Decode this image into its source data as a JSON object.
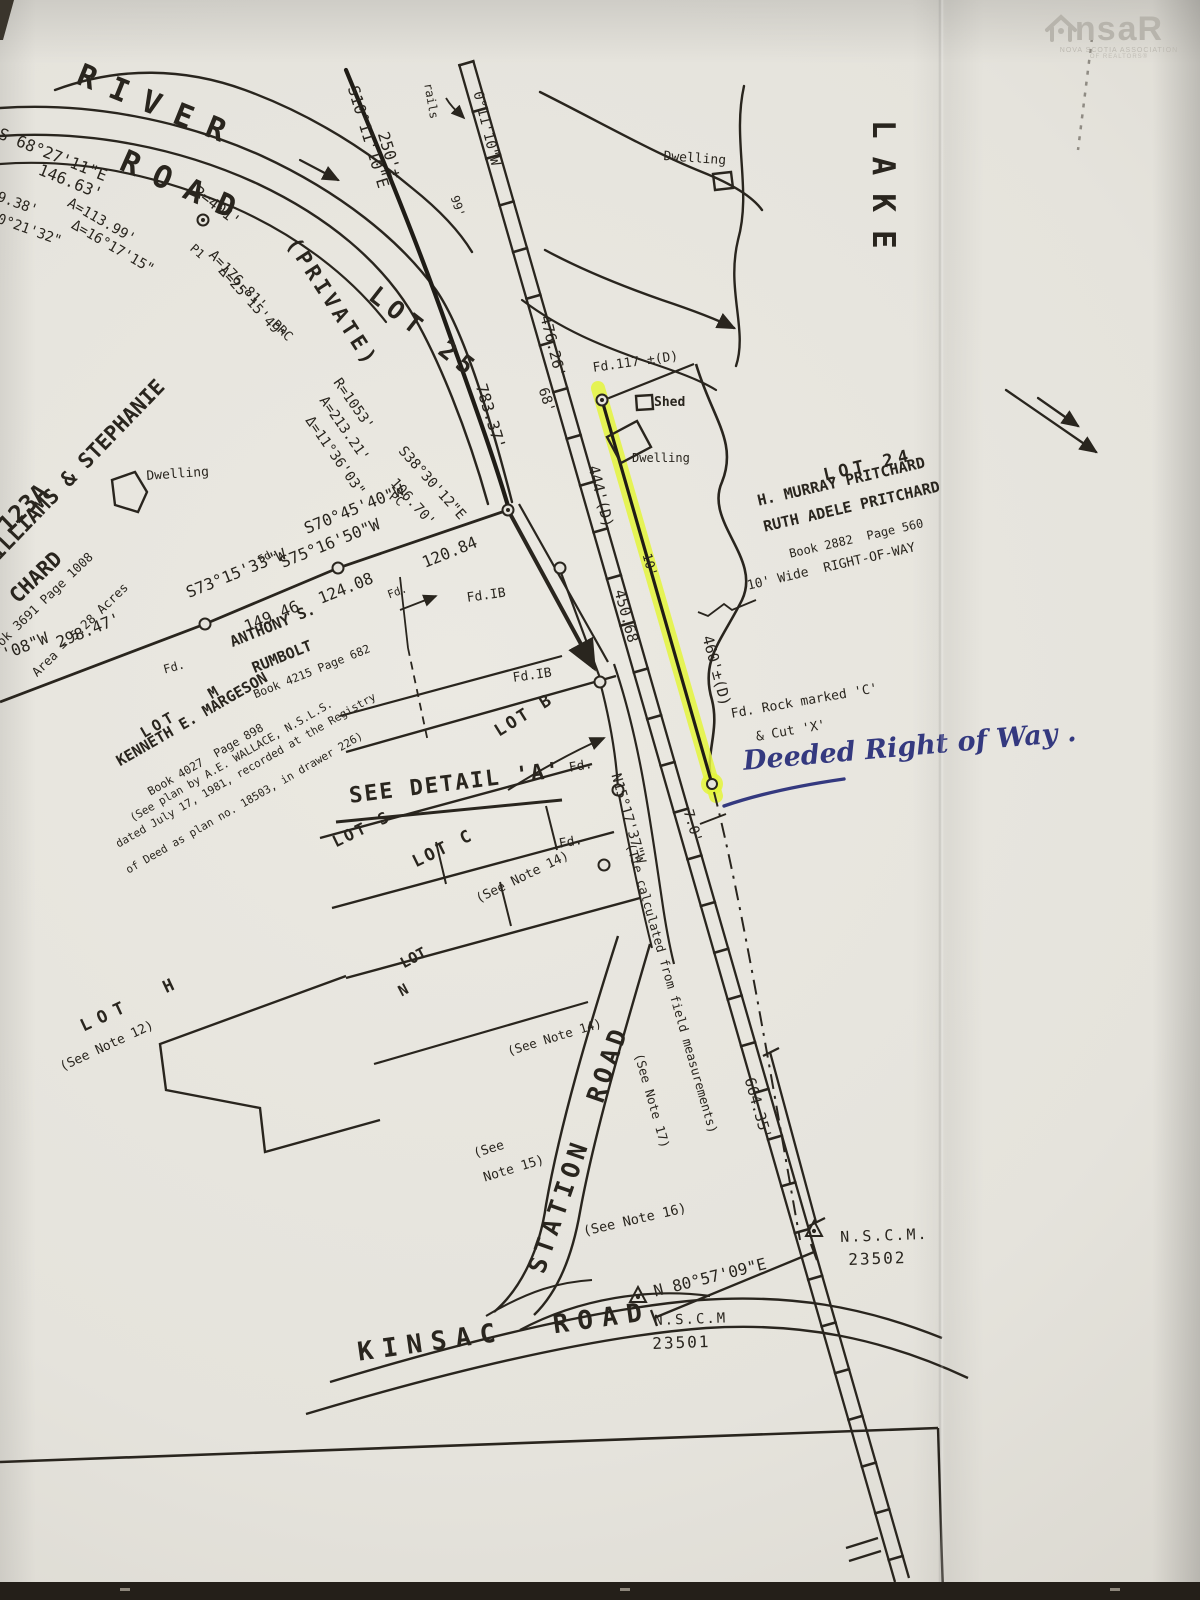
{
  "document": {
    "type_hint": "scanned property survey plan, photographed page",
    "ink_color": "#29251e",
    "highlight_color": "#e4f53c",
    "handwriting_color": "#34397f",
    "paper_color": "#e5e3dc"
  },
  "logo": {
    "ns": "ns",
    "ar": "aR",
    "line1": "NOVA SCOTIA ASSOCIATION",
    "line2": "OF REALTORS®",
    "house_icon": "house-icon"
  },
  "labels": [
    {
      "id": "river",
      "t": "RIVER",
      "x": 84,
      "y": 60,
      "r": 22,
      "s": 31,
      "ls": 16,
      "b": 1
    },
    {
      "id": "road-river",
      "t": "ROAD",
      "x": 128,
      "y": 146,
      "r": 24,
      "s": 31,
      "ls": 16,
      "b": 1
    },
    {
      "id": "brg-s68",
      "t": "S 68°27'11\"E",
      "x": 2,
      "y": 126,
      "r": 22,
      "s": 16
    },
    {
      "id": "dist-14663",
      "t": "146.63'",
      "x": 42,
      "y": 162,
      "r": 22,
      "s": 16
    },
    {
      "id": "dist-938",
      "t": "9.38'",
      "x": 0,
      "y": 190,
      "r": 20,
      "s": 14
    },
    {
      "id": "brg-02132",
      "t": "0°21'32\"",
      "x": 0,
      "y": 212,
      "r": 20,
      "s": 14
    },
    {
      "id": "arc-11399",
      "t": "A=113.99'",
      "x": 72,
      "y": 196,
      "r": 30,
      "s": 14
    },
    {
      "id": "delta-161715",
      "t": "Δ=16°17'15\"",
      "x": 76,
      "y": 218,
      "r": 30,
      "s": 14
    },
    {
      "id": "rad-401",
      "t": "R=401'",
      "x": 200,
      "y": 184,
      "r": 38,
      "s": 15
    },
    {
      "id": "pt-p1-a",
      "t": "P1",
      "x": 196,
      "y": 242,
      "r": 42,
      "s": 12
    },
    {
      "id": "arc-17681",
      "t": "A=176.81'",
      "x": 216,
      "y": 248,
      "r": 46,
      "s": 14
    },
    {
      "id": "delta-251549",
      "t": "Δ=25°15'49\"",
      "x": 226,
      "y": 264,
      "r": 48,
      "s": 14
    },
    {
      "id": "pt-prc",
      "t": "PRC",
      "x": 278,
      "y": 318,
      "r": 45,
      "s": 13
    },
    {
      "id": "private",
      "t": "(PRIVATE)",
      "x": 300,
      "y": 234,
      "r": 57,
      "s": 21,
      "ls": 4,
      "b": 1
    },
    {
      "id": "lot-25",
      "t": "LOT 25",
      "x": 380,
      "y": 282,
      "r": 38,
      "s": 25,
      "ls": 7,
      "b": 1
    },
    {
      "id": "rad-1053",
      "t": "R=1053'",
      "x": 342,
      "y": 376,
      "r": 55,
      "s": 14
    },
    {
      "id": "arc-21321",
      "t": "A=213.21'",
      "x": 328,
      "y": 394,
      "r": 55,
      "s": 14
    },
    {
      "id": "delta-113603",
      "t": "Δ=11°36'03\"",
      "x": 314,
      "y": 414,
      "r": 55,
      "s": 14
    },
    {
      "id": "brg-s38",
      "t": "S38°30'12\"E",
      "x": 406,
      "y": 444,
      "r": 48,
      "s": 14
    },
    {
      "id": "dist-10670",
      "t": "106.70'",
      "x": 398,
      "y": 476,
      "r": 48,
      "s": 14
    },
    {
      "id": "pt-pc",
      "t": "PC",
      "x": 394,
      "y": 490,
      "r": 35,
      "s": 12
    },
    {
      "id": "dist-78337",
      "t": "783.37'",
      "x": 488,
      "y": 382,
      "r": 73,
      "s": 16
    },
    {
      "id": "brg-s10",
      "t": "S10°11'10\"E",
      "x": 360,
      "y": 84,
      "r": 73,
      "s": 16
    },
    {
      "id": "dist-250",
      "t": "250'±",
      "x": 390,
      "y": 130,
      "r": 73,
      "s": 16
    },
    {
      "id": "rails",
      "t": "rails",
      "x": 434,
      "y": 82,
      "r": 80,
      "s": 12
    },
    {
      "id": "brg-s0",
      "t": "0°11'10\"W",
      "x": 484,
      "y": 90,
      "r": 76,
      "s": 14
    },
    {
      "id": "dist-99",
      "t": "99'",
      "x": 460,
      "y": 194,
      "r": 72,
      "s": 12
    },
    {
      "id": "dwelling-1",
      "t": "Dwelling",
      "x": 664,
      "y": 150,
      "r": 4,
      "s": 13
    },
    {
      "id": "lake",
      "t": "LAKE",
      "x": 898,
      "y": 120,
      "r": 90,
      "s": 31,
      "ls": 18,
      "b": 1
    },
    {
      "id": "dist-47626",
      "t": "476.26'",
      "x": 552,
      "y": 314,
      "r": 76,
      "s": 15
    },
    {
      "id": "dist-68",
      "t": "68'",
      "x": 549,
      "y": 386,
      "r": 72,
      "s": 14
    },
    {
      "id": "fd-117",
      "t": "Fd.117 ±(D)",
      "x": 592,
      "y": 362,
      "r": -8,
      "s": 13
    },
    {
      "id": "shed",
      "t": "Shed",
      "x": 654,
      "y": 396,
      "r": 0,
      "s": 13,
      "b": 1
    },
    {
      "id": "dwelling-2",
      "t": "Dwelling",
      "x": 632,
      "y": 452,
      "r": 0,
      "s": 12
    },
    {
      "id": "dist-444",
      "t": "444'(D)",
      "x": 600,
      "y": 464,
      "r": 76,
      "s": 15
    },
    {
      "id": "lot-24",
      "t": "LOT 24",
      "x": 822,
      "y": 468,
      "r": -13,
      "s": 17,
      "ls": 5,
      "b": 1
    },
    {
      "id": "owner-murray",
      "t": "H. MURRAY PRITCHARD",
      "x": 756,
      "y": 494,
      "r": -13,
      "s": 15,
      "b": 1
    },
    {
      "id": "owner-ruth",
      "t": "RUTH ADELE PRITCHARD",
      "x": 762,
      "y": 520,
      "r": -13,
      "s": 15,
      "b": 1
    },
    {
      "id": "book-2882",
      "t": "Book 2882  Page 560",
      "x": 788,
      "y": 548,
      "r": -13,
      "s": 12
    },
    {
      "id": "row-10wide",
      "t": "10' Wide  RIGHT-OF-WAY",
      "x": 746,
      "y": 580,
      "r": -13,
      "s": 13
    },
    {
      "id": "dist-10",
      "t": "10'",
      "x": 652,
      "y": 552,
      "r": 74,
      "s": 13
    },
    {
      "id": "dist-45068",
      "t": "450.68",
      "x": 626,
      "y": 588,
      "r": 75,
      "s": 15
    },
    {
      "id": "dist-460",
      "t": "460'±(D)",
      "x": 714,
      "y": 634,
      "r": 75,
      "s": 15
    },
    {
      "id": "fd-rock-1",
      "t": "Fd. Rock marked 'C'",
      "x": 730,
      "y": 708,
      "r": -10,
      "s": 13
    },
    {
      "id": "fd-rock-2",
      "t": "& Cut 'X'",
      "x": 755,
      "y": 731,
      "r": -10,
      "s": 13
    },
    {
      "id": "handwriting",
      "t": "Deeded Right of Way .",
      "x": 742,
      "y": 748,
      "r": -5,
      "s": 27,
      "hw": 1
    },
    {
      "id": "dist-70",
      "t": "7.0'",
      "x": 694,
      "y": 808,
      "r": 73,
      "s": 14
    },
    {
      "id": "brg-n15",
      "t": "N15°17'37\"W",
      "x": 622,
      "y": 772,
      "r": 74,
      "s": 14
    },
    {
      "id": "tie-note",
      "t": "(Tie calculated from field measurements)",
      "x": 636,
      "y": 842,
      "r": 74,
      "s": 12.5
    },
    {
      "id": "see-note-17",
      "t": "(See Note 17)",
      "x": 644,
      "y": 1052,
      "r": 74,
      "s": 12.5
    },
    {
      "id": "dist-66435",
      "t": "664.35'",
      "x": 756,
      "y": 1076,
      "r": 74,
      "s": 15
    },
    {
      "id": "brg-s70",
      "t": "S70°45'40\"W",
      "x": 302,
      "y": 522,
      "r": -22,
      "s": 16
    },
    {
      "id": "dist-12084",
      "t": "120.84",
      "x": 420,
      "y": 556,
      "r": -22,
      "s": 16
    },
    {
      "id": "brg-s75",
      "t": "S75°16'50\"W",
      "x": 278,
      "y": 556,
      "r": -22,
      "s": 16
    },
    {
      "id": "dist-12408",
      "t": "124.08",
      "x": 316,
      "y": 592,
      "r": -22,
      "s": 16
    },
    {
      "id": "brg-s73",
      "t": "S73°15'33\"W",
      "x": 184,
      "y": 586,
      "r": -22,
      "s": 16
    },
    {
      "id": "dist-14946",
      "t": "149.46",
      "x": 242,
      "y": 620,
      "r": -22,
      "s": 16
    },
    {
      "id": "brg-08w",
      "t": "'08\"W",
      "x": 0,
      "y": 648,
      "r": -22,
      "s": 16
    },
    {
      "id": "dist-29847",
      "t": "298.47'",
      "x": 54,
      "y": 636,
      "r": -22,
      "s": 16
    },
    {
      "id": "fd-a",
      "t": "Fd.",
      "x": 162,
      "y": 664,
      "r": -15,
      "s": 12
    },
    {
      "id": "fd-b",
      "t": "Fd.",
      "x": 256,
      "y": 556,
      "r": -30,
      "s": 11
    },
    {
      "id": "fd-c",
      "t": "Fd.",
      "x": 386,
      "y": 590,
      "r": -20,
      "s": 11
    },
    {
      "id": "fd-ib-1",
      "t": "Fd.IB",
      "x": 466,
      "y": 592,
      "r": -8,
      "s": 13
    },
    {
      "id": "fd-ib-2",
      "t": "Fd.IB",
      "x": 512,
      "y": 672,
      "r": -8,
      "s": 13
    },
    {
      "id": "owner-anthony",
      "t": "ANTHONY S.",
      "x": 228,
      "y": 636,
      "r": -22,
      "s": 15,
      "b": 1
    },
    {
      "id": "owner-rumbolt",
      "t": "RUMBOLT",
      "x": 250,
      "y": 662,
      "r": -22,
      "s": 15,
      "b": 1
    },
    {
      "id": "book-4215",
      "t": "Book 4215 Page 682",
      "x": 252,
      "y": 690,
      "r": -22,
      "s": 11.5
    },
    {
      "id": "lot-m",
      "t": "LOT   M",
      "x": 138,
      "y": 728,
      "r": -30,
      "s": 15,
      "ls": 4,
      "b": 1
    },
    {
      "id": "owner-kenneth",
      "t": "KENNETH E. MARGESON",
      "x": 114,
      "y": 756,
      "r": -30,
      "s": 15,
      "b": 1
    },
    {
      "id": "book-4027",
      "t": "Book 4027  Page 898",
      "x": 146,
      "y": 788,
      "r": -30,
      "s": 11.5
    },
    {
      "id": "plan-note-1",
      "t": "(See plan by A.E. WALLACE, N.S.L.S.",
      "x": 128,
      "y": 814,
      "r": -30,
      "s": 11
    },
    {
      "id": "plan-note-2",
      "t": "dated July 17, 1981, recorded at the Registry",
      "x": 114,
      "y": 840,
      "r": -30,
      "s": 11
    },
    {
      "id": "plan-note-3",
      "t": "of Deed as plan no. 18503, in drawer 226)",
      "x": 124,
      "y": 866,
      "r": -30,
      "s": 11
    },
    {
      "id": "lot-b",
      "t": "LOT B",
      "x": 492,
      "y": 726,
      "r": -32,
      "s": 17,
      "ls": 3,
      "b": 1
    },
    {
      "id": "fd-d",
      "t": "Fd.",
      "x": 568,
      "y": 762,
      "r": -10,
      "s": 13
    },
    {
      "id": "see-detail",
      "t": "SEE DETAIL 'A'",
      "x": 348,
      "y": 786,
      "r": -7,
      "s": 22,
      "ls": 2,
      "b": 1
    },
    {
      "id": "lot-s",
      "t": "LOT S",
      "x": 330,
      "y": 836,
      "r": -26,
      "s": 16,
      "ls": 3,
      "b": 1
    },
    {
      "id": "lot-c",
      "t": "LOT C",
      "x": 410,
      "y": 856,
      "r": -26,
      "s": 17,
      "ls": 3,
      "b": 1
    },
    {
      "id": "fd-e",
      "t": "Fd.",
      "x": 558,
      "y": 838,
      "r": -10,
      "s": 13
    },
    {
      "id": "see-note-14a",
      "t": "(See Note 14)",
      "x": 474,
      "y": 894,
      "r": -26,
      "s": 13
    },
    {
      "id": "lot-n-1",
      "t": "LOT",
      "x": 398,
      "y": 958,
      "r": -28,
      "s": 15,
      "b": 1
    },
    {
      "id": "lot-n-2",
      "t": "N",
      "x": 396,
      "y": 986,
      "r": -28,
      "s": 15,
      "b": 1
    },
    {
      "id": "see-note-14b",
      "t": "(See Note 14)",
      "x": 506,
      "y": 1046,
      "r": -17,
      "s": 12.5
    },
    {
      "id": "see-note-15a",
      "t": "(See",
      "x": 472,
      "y": 1148,
      "r": -17,
      "s": 13
    },
    {
      "id": "see-note-15b",
      "t": "Note 15)",
      "x": 482,
      "y": 1172,
      "r": -17,
      "s": 13
    },
    {
      "id": "lot-h",
      "t": "LOT  H",
      "x": 78,
      "y": 1020,
      "r": -25,
      "s": 17,
      "ls": 8,
      "b": 1
    },
    {
      "id": "see-note-12",
      "t": "(See Note 12)",
      "x": 58,
      "y": 1062,
      "r": -25,
      "s": 13
    },
    {
      "id": "station-road",
      "t": "STATION  ROAD",
      "x": 524,
      "y": 1268,
      "r": -71,
      "s": 25,
      "ls": 5,
      "b": 1
    },
    {
      "id": "see-note-16",
      "t": "(See Note 16)",
      "x": 582,
      "y": 1226,
      "r": -13,
      "s": 13.5
    },
    {
      "id": "brg-n80",
      "t": "N 80°57'09\"E",
      "x": 652,
      "y": 1284,
      "r": -14,
      "s": 16
    },
    {
      "id": "nscm-2a",
      "t": "N.S.C.M.",
      "x": 840,
      "y": 1230,
      "r": -2,
      "s": 15,
      "ls": 2
    },
    {
      "id": "nscm-2b",
      "t": "23502",
      "x": 848,
      "y": 1252,
      "r": -2,
      "s": 16,
      "ls": 2
    },
    {
      "id": "nscm-1a",
      "t": "N.S.C.M",
      "x": 654,
      "y": 1314,
      "r": -2,
      "s": 14,
      "ls": 2
    },
    {
      "id": "nscm-1b",
      "t": "23501",
      "x": 652,
      "y": 1336,
      "r": -2,
      "s": 16,
      "ls": 2
    },
    {
      "id": "kinsac-road",
      "t": "KINSAC  ROAD",
      "x": 356,
      "y": 1340,
      "r": -8,
      "s": 26,
      "ls": 9,
      "b": 1
    },
    {
      "id": "name-123a",
      "t": "123A",
      "x": -6,
      "y": 520,
      "r": -44,
      "s": 24,
      "b": 1
    },
    {
      "id": "name-williams",
      "t": "WILLIAMS & STEPHANIE",
      "x": -22,
      "y": 558,
      "r": -46,
      "s": 21,
      "b": 1
    },
    {
      "id": "name-chard",
      "t": "CHARD",
      "x": 6,
      "y": 592,
      "r": -44,
      "s": 21,
      "b": 1
    },
    {
      "id": "book-3691",
      "t": "Book 3691 Page 1008",
      "x": -16,
      "y": 650,
      "r": -44,
      "s": 12.5
    },
    {
      "id": "area-528",
      "t": "Area = 5.28 Acres",
      "x": 30,
      "y": 670,
      "r": -44,
      "s": 12.5
    },
    {
      "id": "dwelling-3",
      "t": "Dwelling",
      "x": 146,
      "y": 470,
      "r": -4,
      "s": 13
    }
  ]
}
